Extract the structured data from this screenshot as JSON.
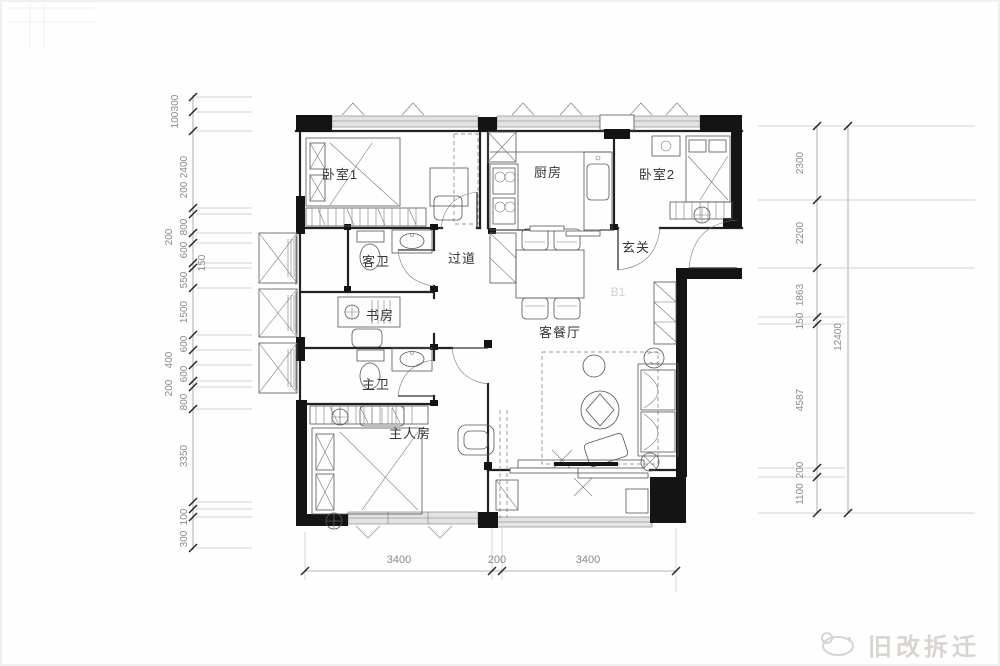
{
  "rooms": {
    "bedroom1": "卧室1",
    "kitchen": "厨房",
    "bedroom2": "卧室2",
    "guest_bath": "客卫",
    "hallway": "过道",
    "foyer": "玄关",
    "study": "书房",
    "living_dining": "客餐厅",
    "master_bath": "主卫",
    "master_bedroom": "主人房"
  },
  "unit": {
    "floor_tag": "B1"
  },
  "dims": {
    "left": [
      "300",
      "100",
      "2400",
      "200",
      "800",
      "200",
      "600",
      "150",
      "550",
      "1500",
      "600",
      "400",
      "600",
      "200",
      "800",
      "3350",
      "100",
      "300"
    ],
    "right": [
      "2300",
      "2200",
      "1863",
      "150",
      "4587",
      "200",
      "1100"
    ],
    "right_total": "12400",
    "bottom": [
      "3400",
      "200",
      "3400"
    ]
  },
  "watermark": {
    "text": "旧改拆迁"
  },
  "colors": {
    "wall": "#141414",
    "dim_text": "#8a8a8a",
    "label_text": "#353535",
    "watermark": "#d8d4cf"
  }
}
